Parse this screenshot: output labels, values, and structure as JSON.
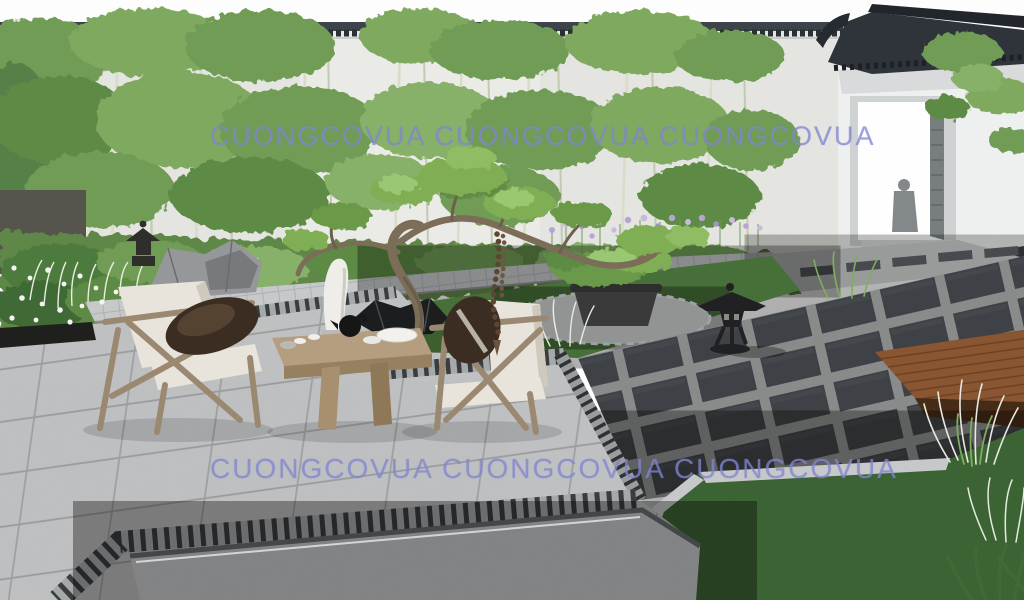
{
  "watermark": {
    "text": "CUONGCOVUA  CUONGCOVUA  CUONGCOVUA",
    "color": "#8186d0",
    "rows": 2
  },
  "palette": {
    "sky": "#fdfdfd",
    "wall_stucco": "#e8e8e5",
    "roof_tile": "#2f343b",
    "bamboo_green": "#6f9c54",
    "pine_green": "#7fae54",
    "lawn_green": "#67a052",
    "lawn_green_far": "#578f4c",
    "paving_slab": "#dadbdc",
    "paver_dark": "#3e4145",
    "gravel": "#c9cbcc",
    "deck_wood": "#8a5632",
    "furniture_wood": "#a08a6e",
    "cushion_cream": "#e9e4db",
    "pillow_dark": "#3b2d22",
    "iris_purple": "#b7a4d4",
    "lantern_stone": "#212124",
    "pot_black": "#3a3a3a",
    "beads_brown": "#5d4631"
  }
}
